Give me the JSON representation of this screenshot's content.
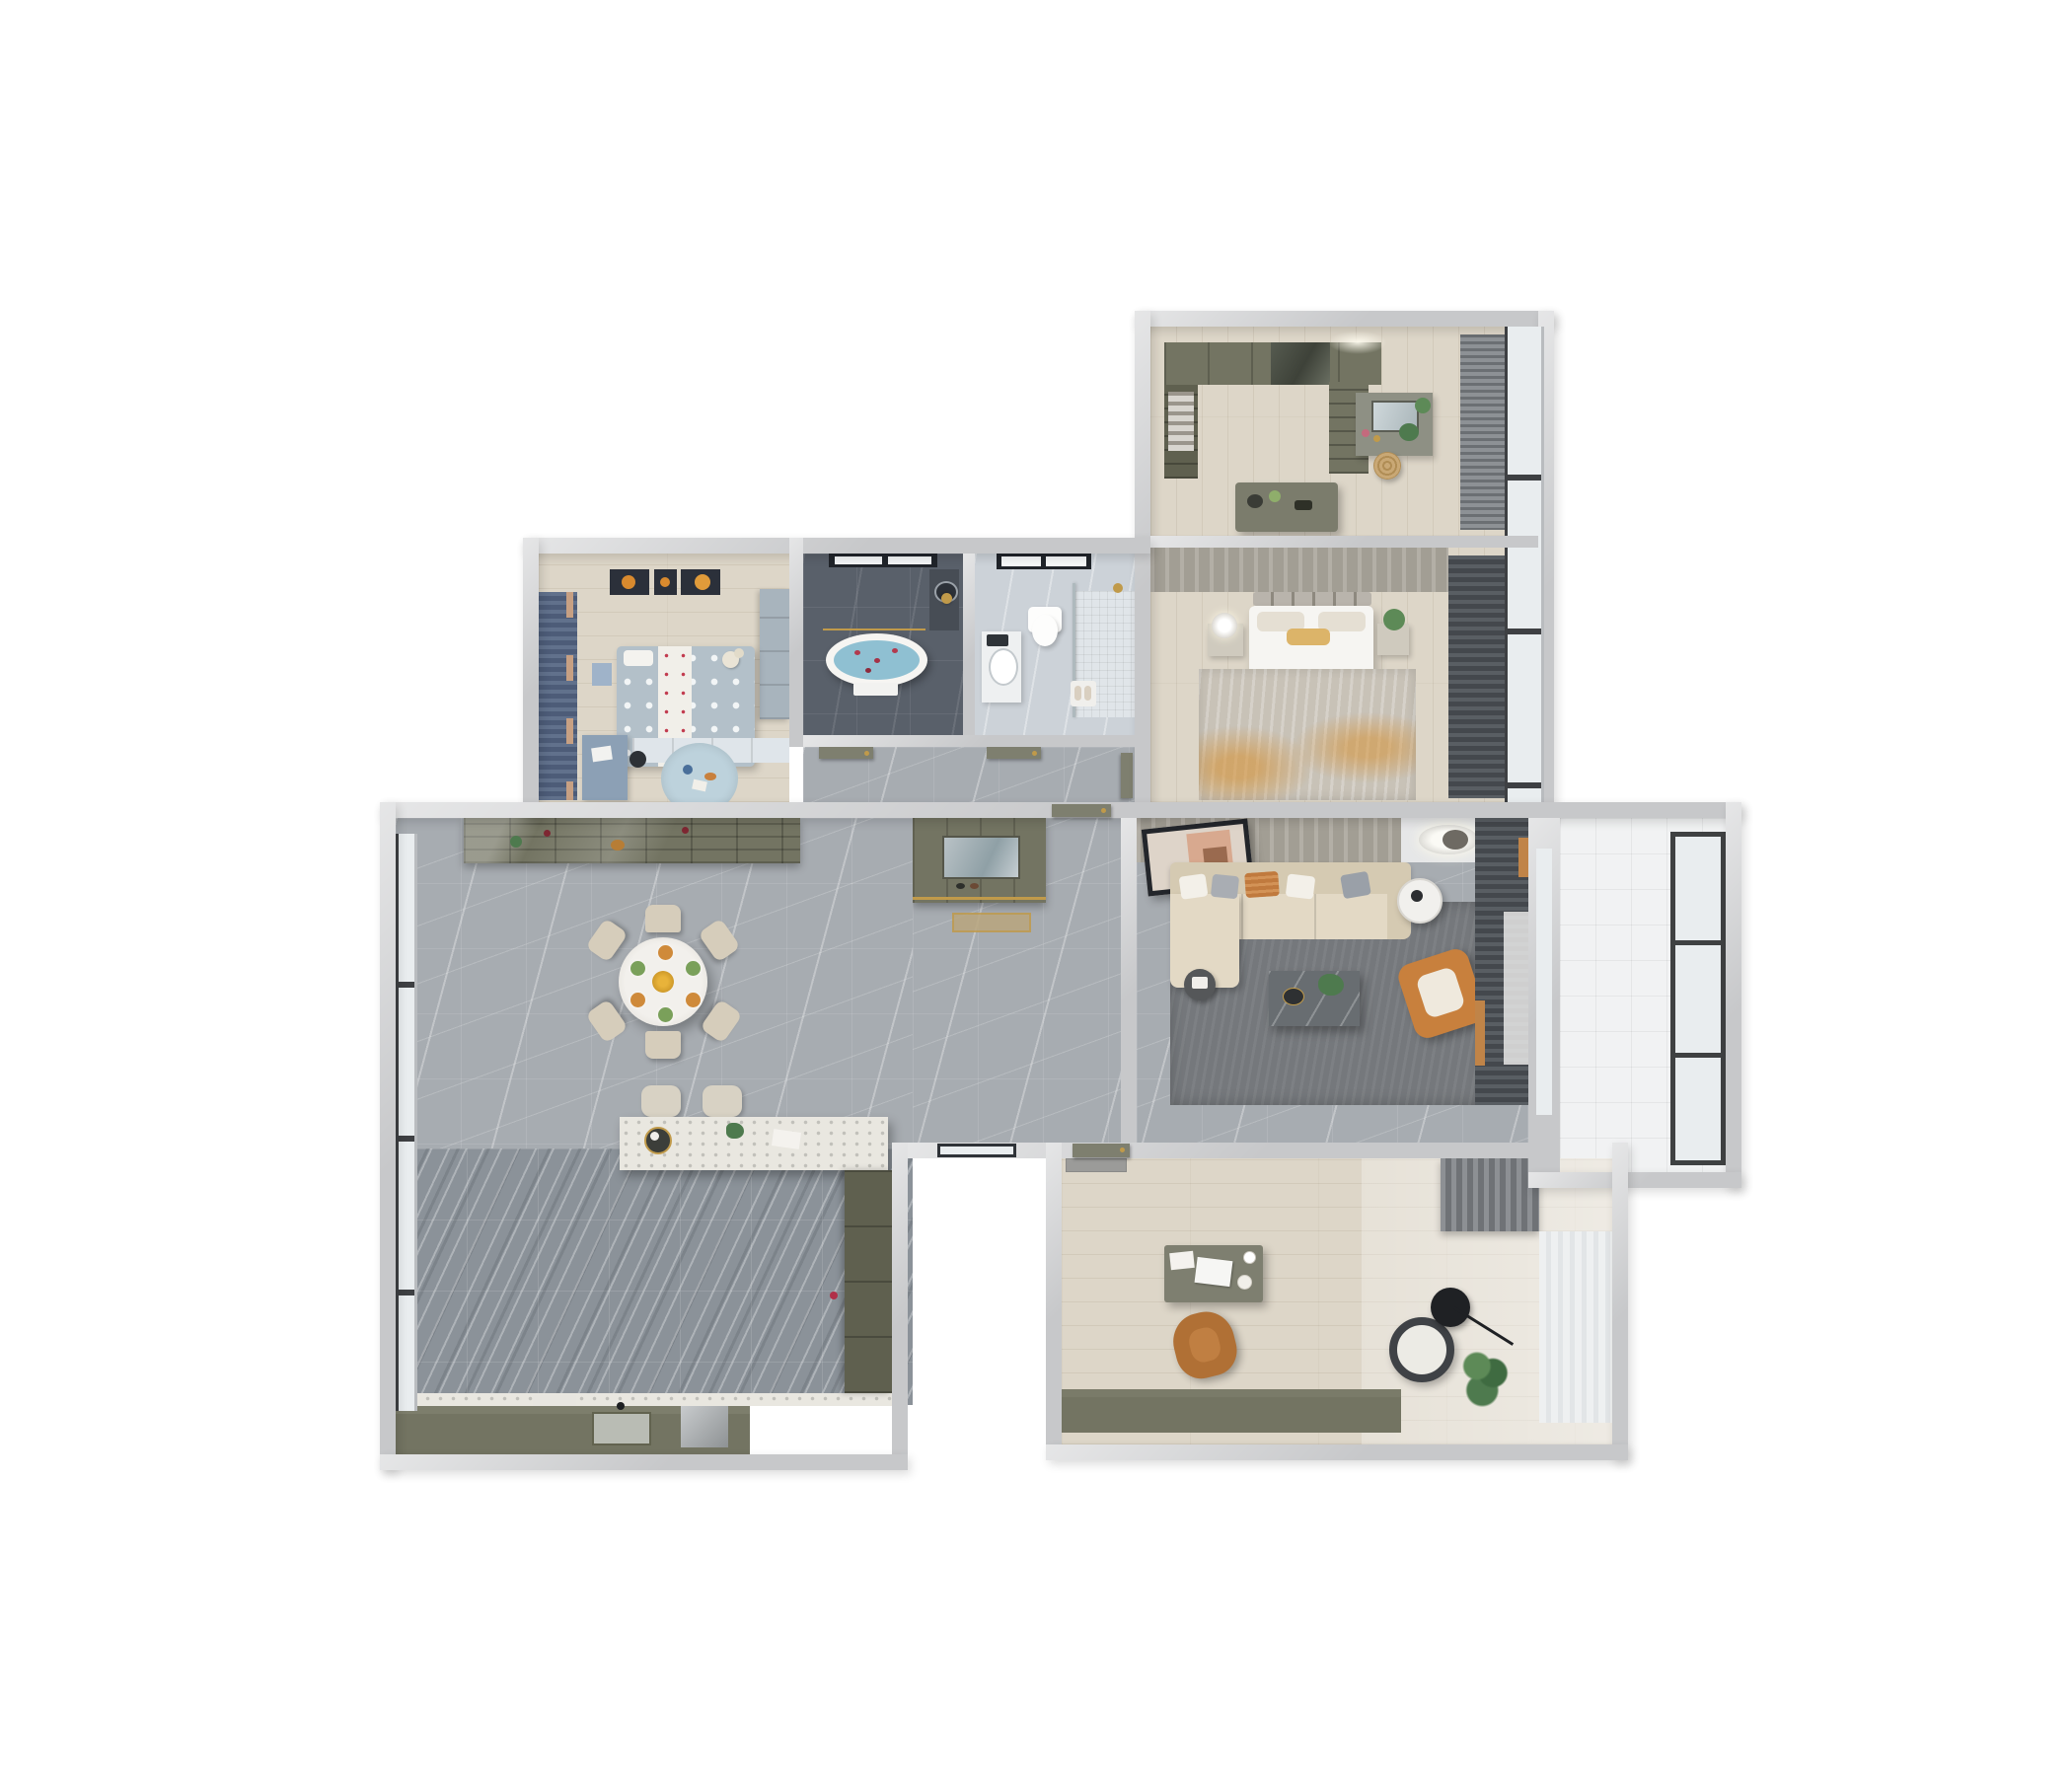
{
  "scene": {
    "title": "3D apartment floor plan, top-down render",
    "view": "top-down axonometric",
    "background": "#ffffff",
    "visible_text": []
  },
  "palette": {
    "wall": "#c7c8ca",
    "wood": "#ddd6c8",
    "wood_light": "#e7e3da",
    "marble_light": "#a7acb1",
    "marble_dark": "#8b9299",
    "slate": "#59606a",
    "bath_light": "#ccd2d8",
    "olive": "#737462",
    "olive_dark": "#5f604f",
    "sofa": "#e3d9c5",
    "sofa_dark": "#d5cab2",
    "orange": "#c8803d",
    "gold": "#c09a4a",
    "water": "#8fc0d2",
    "rug_living": "#75787c",
    "rug_bed": "#c8c2b7",
    "rug_kids": "#bdd2dc",
    "curtain_dark": "#53575c",
    "curtain_kids": "#5c6c88",
    "door": "#7e7f6f",
    "balcony": "#f1f2f3",
    "glass": "#e9edef",
    "white": "#f6f5f2"
  },
  "rooms": [
    {
      "name": "walk-in-closet",
      "floor": "light wood",
      "furniture": [
        "wardrobe-run",
        "glass-wardrobe",
        "open-shelving",
        "island-dresser",
        "vanity-with-mirror",
        "rattan-basket",
        "window-blinds"
      ]
    },
    {
      "name": "master-bedroom",
      "floor": "light wood",
      "furniture": [
        "double-bed",
        "paneled-headboard",
        "nightstand-left",
        "table-lamp",
        "nightstand-right",
        "plant",
        "distressed-rug",
        "blackout-curtains",
        "window-wall"
      ]
    },
    {
      "name": "master-bathroom",
      "floor": "dark slate tile",
      "furniture": [
        "freestanding-oval-bathtub",
        "rose-petals",
        "black-frame-window",
        "gold-shower-fixture",
        "towel-rail",
        "counter-basin"
      ]
    },
    {
      "name": "guest-bathroom",
      "floor": "light marble tile",
      "furniture": [
        "wall-hung-toilet",
        "vanity-basin",
        "walk-in-shower",
        "glass-partition",
        "black-frame-window",
        "gold-fixture",
        "bath-mat",
        "slippers"
      ]
    },
    {
      "name": "kids-bedroom",
      "floor": "light wood",
      "furniture": [
        "polka-dot-bed",
        "white-runner",
        "teddy-bear",
        "space-art-triptych",
        "blue-curtains",
        "wardrobe",
        "low-cabinet",
        "desk",
        "desk-chair",
        "round-play-rug",
        "nightstand"
      ]
    },
    {
      "name": "hallway",
      "floor": "gray marble",
      "furniture": [
        "bathroom-door",
        "bathroom-door",
        "bedroom-door"
      ]
    },
    {
      "name": "foyer",
      "floor": "gray marble",
      "furniture": [
        "entry-console-with-mirror",
        "doormat",
        "entry-door"
      ]
    },
    {
      "name": "dining-area",
      "floor": "gray marble",
      "furniture": [
        "round-dining-table",
        "dining-chairs-6",
        "place-settings",
        "flower-centerpiece",
        "wine-sideboard",
        "floor-to-ceiling-window"
      ]
    },
    {
      "name": "kitchen",
      "floor": "dark veined marble",
      "furniture": [
        "terrazzo-bar-island",
        "bar-stools-2",
        "counter-run",
        "sink",
        "cooktop-appliance",
        "cutting-board",
        "tall-cabinets",
        "floor-to-ceiling-window"
      ]
    },
    {
      "name": "living-room",
      "floor": "gray marble + rug",
      "furniture": [
        "l-shaped-sectional-sofa",
        "throw-pillows-5",
        "leaning-artwork",
        "ring-ceiling-light",
        "round-side-table",
        "marble-coffee-table",
        "plant",
        "orange-accent-armchair",
        "small-side-table",
        "dark-area-rug",
        "curtain-wall"
      ]
    },
    {
      "name": "balcony",
      "floor": "white tile",
      "furniture": [
        "full-height-window"
      ]
    },
    {
      "name": "study",
      "floor": "light wood",
      "furniture": [
        "writing-desk",
        "laptop",
        "papers",
        "coffee-cup",
        "leather-desk-chair",
        "lounge-chair",
        "arc-floor-lamp",
        "potted-plant",
        "gray-curtain",
        "sheer-window",
        "low-bookcase",
        "ceiling-hatch"
      ]
    },
    {
      "name": "exterior-void",
      "floor": "none",
      "furniture": [
        "glass-door-to-dining",
        "study-door"
      ]
    }
  ]
}
